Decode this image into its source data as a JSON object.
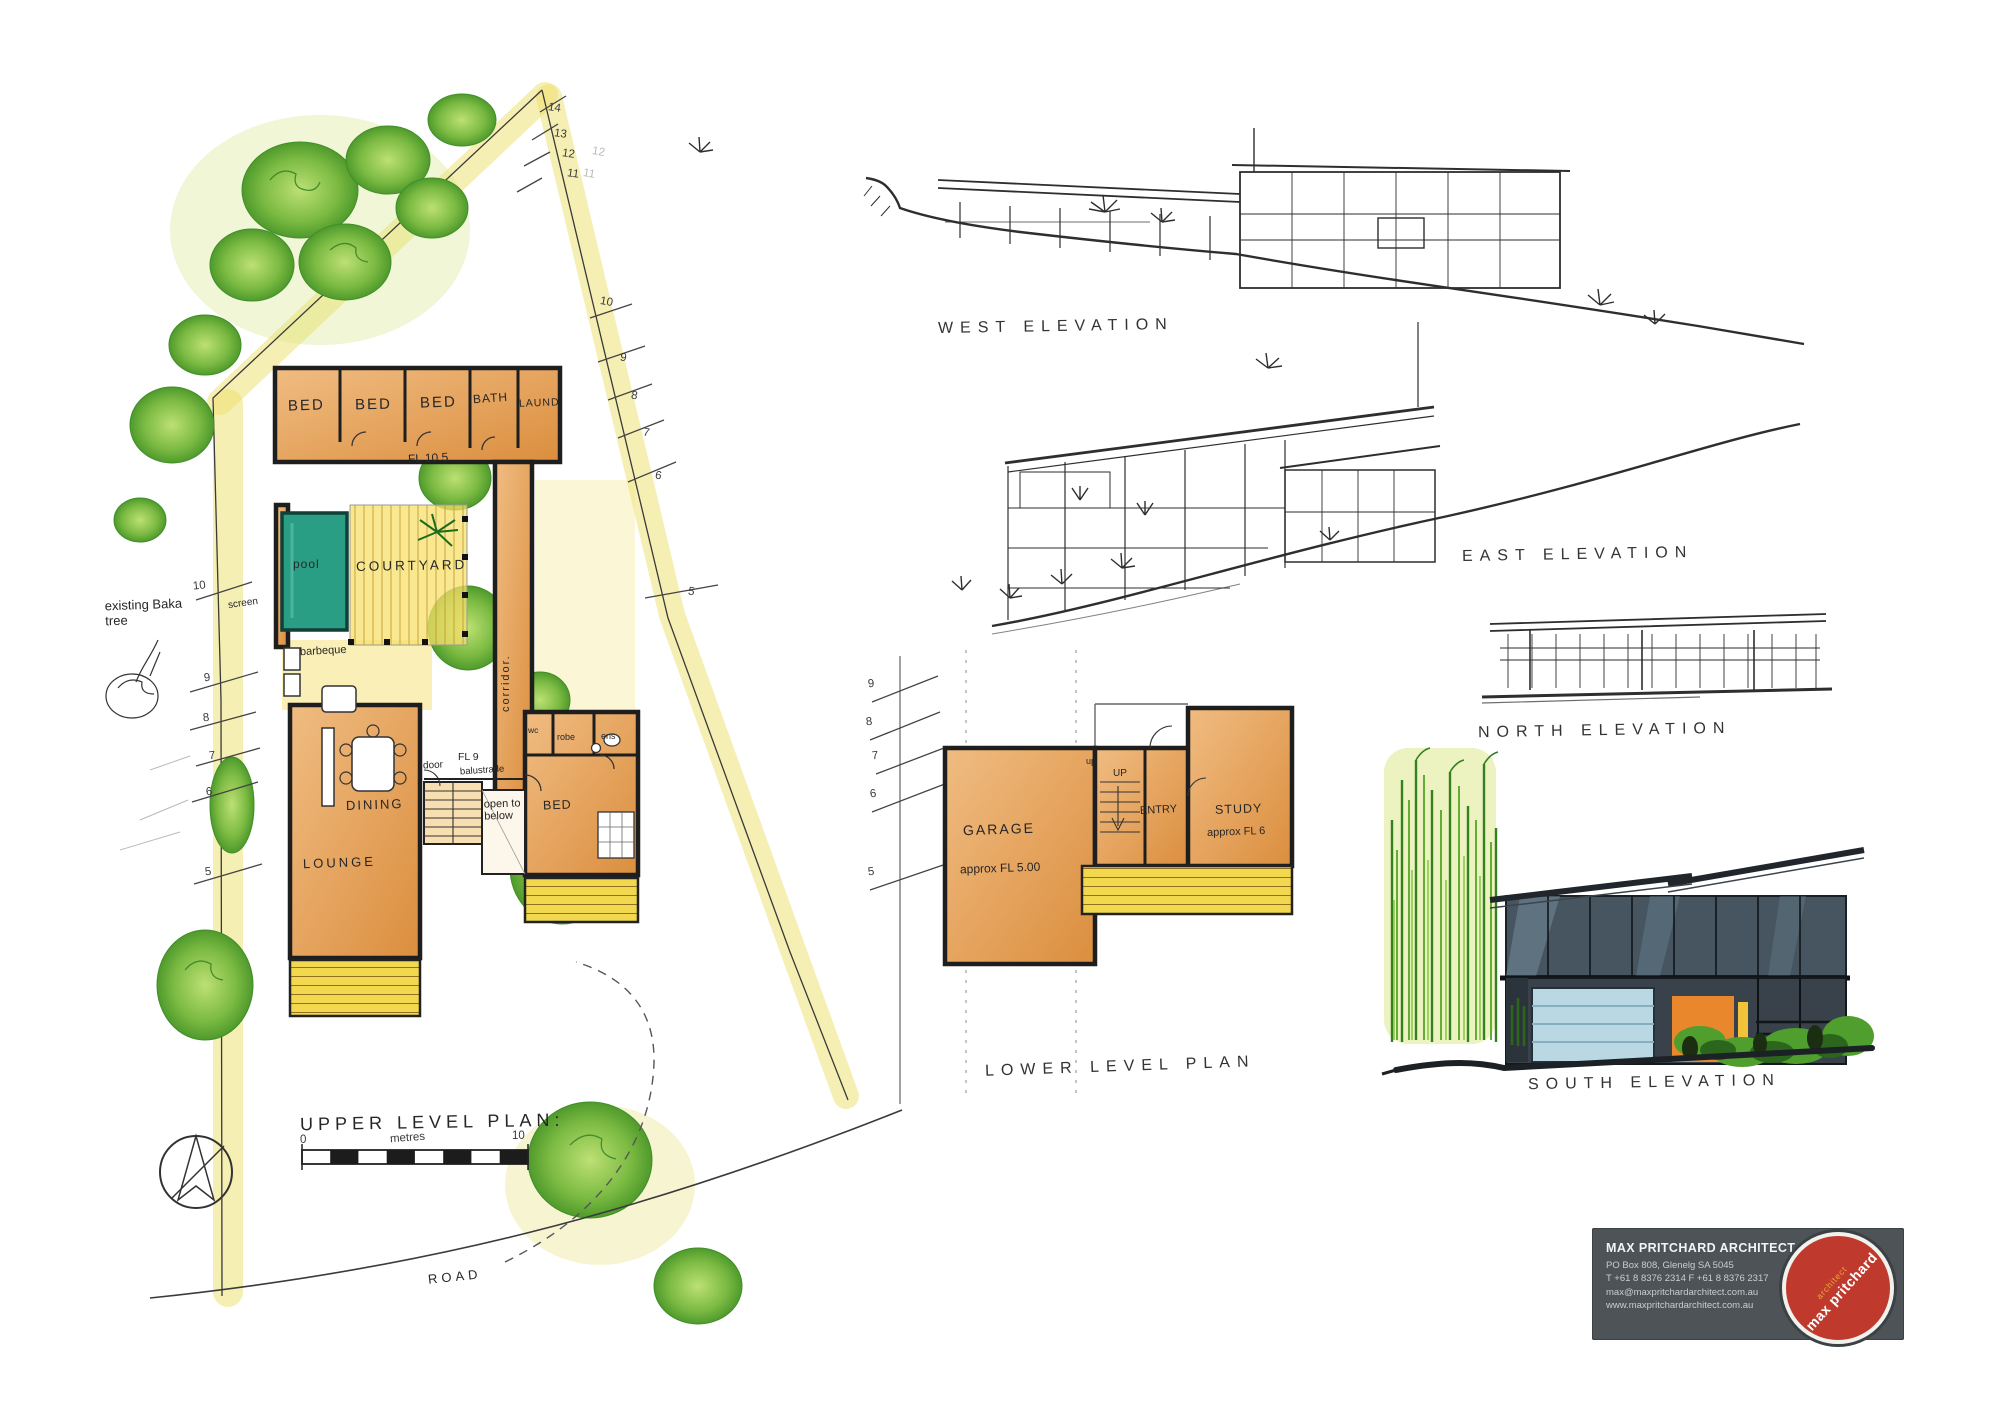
{
  "sheet": {
    "titles": {
      "west": "WEST ELEVATION",
      "east": "EAST ELEVATION",
      "north": "NORTH ELEVATION",
      "south": "SOUTH ELEVATION",
      "upper": "UPPER LEVEL PLAN:",
      "lower": "LOWER LEVEL PLAN",
      "road": "ROAD"
    }
  },
  "upper_plan": {
    "rooms": {
      "bed": "BED",
      "bath": "BATH",
      "laundry": "LAUND",
      "pool": "pool",
      "courtyard": "COURTYARD",
      "dining": "DINING",
      "lounge": "LOUNGE",
      "robe": "robe",
      "ens": "ens",
      "wc": "wc"
    },
    "notes": {
      "fl_upper": "FL 10.5",
      "fl_mid": "FL 9",
      "door": "door",
      "balustrade": "balustrade",
      "open_below": "open to\nbelow",
      "corridor": "corridor.",
      "barbeque": "barbeque",
      "screen": "screen",
      "existing_tree": "existing Baka\ntree"
    },
    "contours_top": [
      "14",
      "13",
      "12",
      "11"
    ],
    "contours_top_faint": [
      "12",
      "11"
    ],
    "contours_right": [
      "10",
      "9",
      "8",
      "7",
      "6",
      "5"
    ],
    "contours_left": [
      "10",
      "9",
      "8",
      "7",
      "6",
      "5"
    ],
    "scale_bar": {
      "zero": "0",
      "unit": "metres",
      "ten": "10"
    }
  },
  "lower_plan": {
    "rooms": {
      "garage": "GARAGE",
      "entry": "ENTRY",
      "study": "STUDY"
    },
    "notes": {
      "garage_fl": "approx FL 5.00",
      "study_fl": "approx FL 6",
      "up_small": "up",
      "up": "UP"
    },
    "contours_left": [
      "9",
      "8",
      "7",
      "6",
      "5"
    ]
  },
  "stamp": {
    "firm": "MAX PRITCHARD ARCHITECT",
    "address": "PO Box 808, Glenelg SA 5045",
    "phones": "T +61 8 8376 2314   F +61 8 8376 2317",
    "email": "max@maxpritchardarchitect.com.au",
    "website": "www.maxpritchardarchitect.com.au",
    "logo_name": "max pritchard",
    "logo_role": "architect"
  },
  "colors": {
    "wall_orange": "#e1943f",
    "wash_yellow": "#eee06a",
    "tree_green": "#6fb23a",
    "pool_teal": "#2a9e85",
    "stamp_grey": "#4d5357",
    "stamp_red": "#bf3a2d",
    "ink": "#2b2b2b"
  }
}
